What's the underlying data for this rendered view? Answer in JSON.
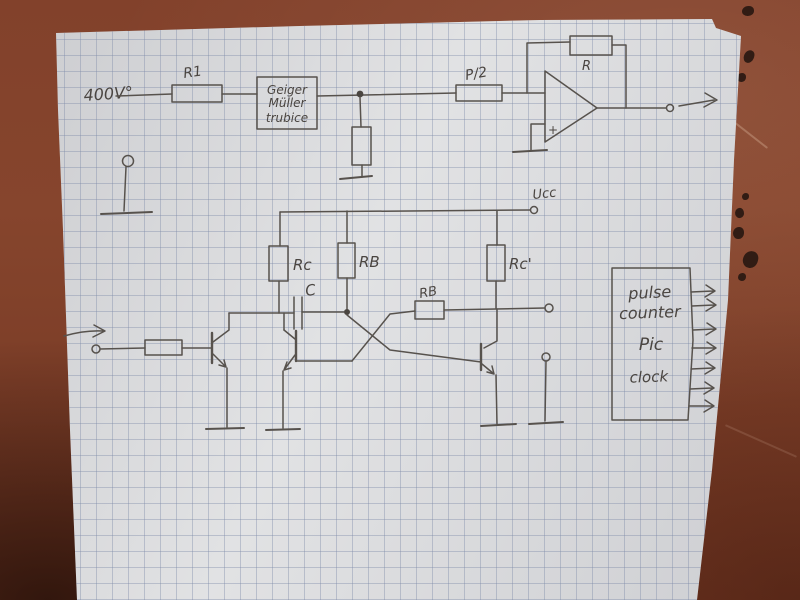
{
  "colors": {
    "table": "#82412b",
    "table_shadow": "#3c1c0e",
    "paper": "#d8d9db",
    "grid_line": "#7d8aa8",
    "pencil": "#57524d"
  },
  "schematic": {
    "hv": "400V°",
    "r1": "R1",
    "tube1": "Geiger",
    "tube2": "Müller",
    "tube3": "trubice",
    "p2": "P/2",
    "rf": "R",
    "plus": "+",
    "ucc": "Ucc",
    "rc1": "Rc",
    "rb1": "RB",
    "rc2": "Rc'",
    "c": "C",
    "rb2": "RB",
    "box1": "pulse",
    "box2": "counter",
    "box3": "Pic",
    "box4": "clock"
  }
}
